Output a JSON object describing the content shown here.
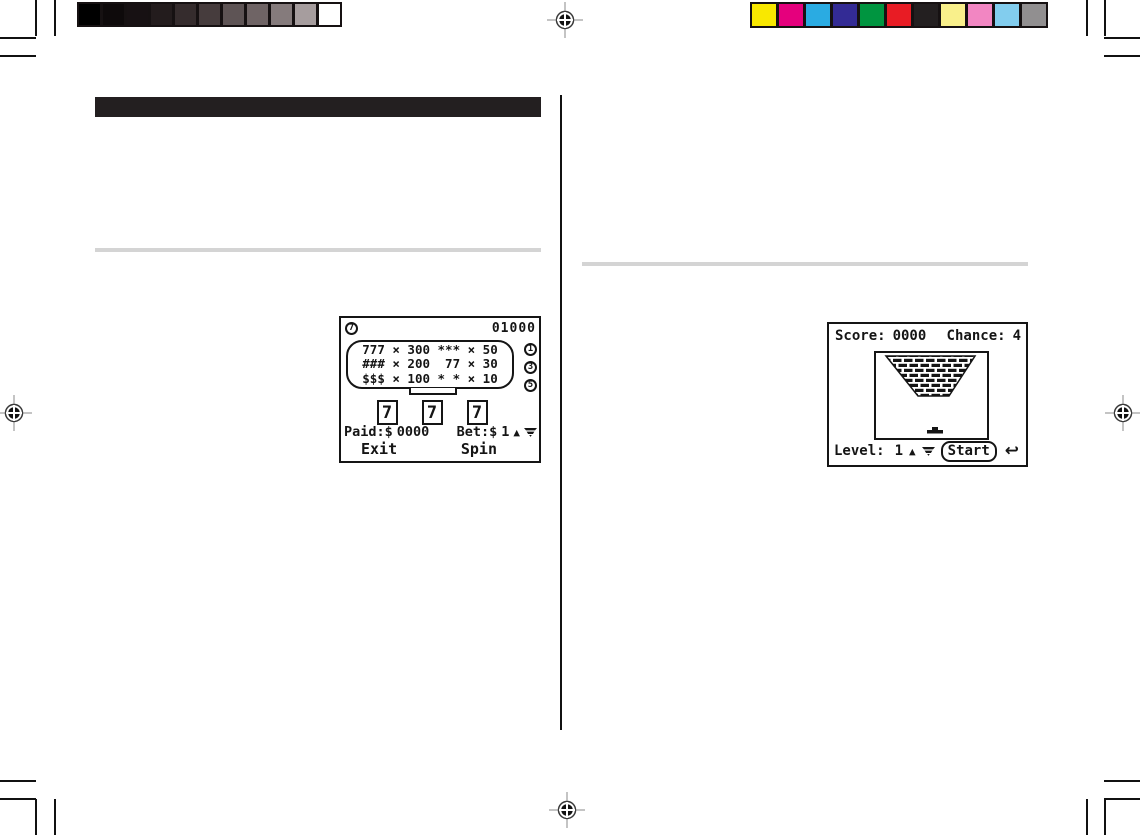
{
  "calibration": {
    "grayscale_colors": [
      "#000000",
      "#0e0a0b",
      "#171113",
      "#231c1d",
      "#352c2d",
      "#463c3d",
      "#5e5455",
      "#6f6465",
      "#857b7c",
      "#a69d9e",
      "#ffffff"
    ],
    "color_bar_colors": [
      "#f9e800",
      "#e5007d",
      "#2aabe2",
      "#332b95",
      "#009540",
      "#e81c24",
      "#231f20",
      "#f9f08b",
      "#f286c2",
      "#82cdee",
      "#918f90"
    ]
  },
  "header": {
    "bar_color": "#231f20"
  },
  "slot_screen": {
    "seven_badge": "7",
    "credit_counter": "01000",
    "paytable_rows": [
      {
        "line": "777 × 300 *** × 50",
        "badge": "1"
      },
      {
        "line": "### × 200  77 × 30",
        "badge": "3"
      },
      {
        "line": "$$$ × 100 * * × 10",
        "badge": "5"
      }
    ],
    "reels": [
      "7",
      "7",
      "7"
    ],
    "paid_label": "Paid:$",
    "paid_value": "0000",
    "bet_label": "Bet:$",
    "bet_value": "1",
    "exit_label": "Exit",
    "spin_label": "Spin"
  },
  "brick_screen": {
    "score_label": "Score:",
    "score_value": "0000",
    "chance_label": "Chance:",
    "chance_value": "4",
    "level_label": "Level:",
    "level_value": "1",
    "start_label": "Start"
  },
  "icons": {
    "up_arrow": "▲",
    "return_arrow": "↩"
  }
}
